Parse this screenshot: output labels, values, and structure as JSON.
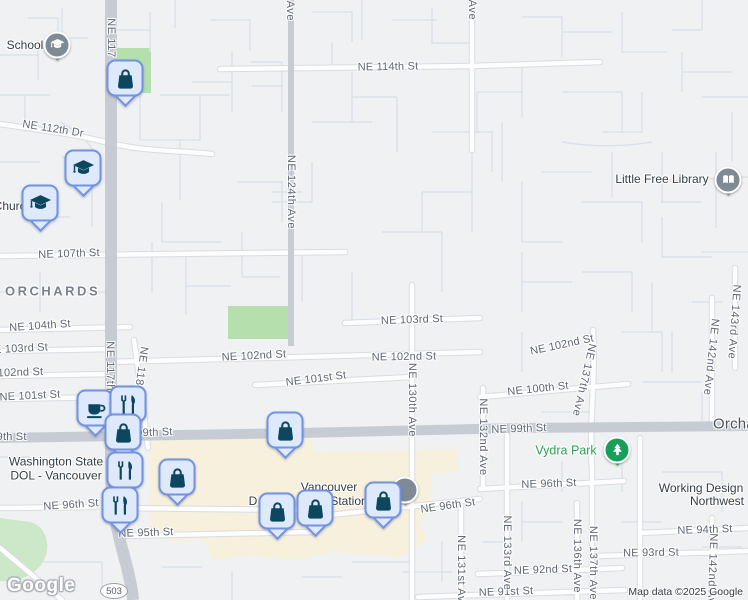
{
  "map": {
    "attribution": "Map data ©2025 Google",
    "watermark": "Google",
    "route_badge": "503"
  },
  "colors": {
    "land": "#f0f1f3",
    "commercial_area": "#f6f0dd",
    "park_green": "#b5e0ae",
    "marker_fill": "#dfe9fc",
    "marker_border": "#7292e2",
    "marker_glyph": "#0d475f",
    "poi_pin_gray": "#7e8b94",
    "park_pin_green": "#18a05b",
    "park_label_green": "#2f9e51"
  },
  "street_labels": [
    {
      "t": "NE 114th St",
      "x": 388,
      "y": 67,
      "r": -1
    },
    {
      "t": "NE 112th Dr",
      "x": 53,
      "y": 129,
      "r": 9
    },
    {
      "t": "NE 107th St",
      "x": 69,
      "y": 254,
      "r": -2
    },
    {
      "t": "NE 104th St",
      "x": 40,
      "y": 326,
      "r": -4
    },
    {
      "t": "NE 103rd St",
      "x": 17,
      "y": 349,
      "r": -3
    },
    {
      "t": "NE 102nd St",
      "x": 11,
      "y": 373,
      "r": -2
    },
    {
      "t": "NE 101st St",
      "x": 30,
      "y": 396,
      "r": -3
    },
    {
      "t": "NE 102nd St",
      "x": 254,
      "y": 356,
      "r": -3
    },
    {
      "t": "NE 102nd St",
      "x": 404,
      "y": 357,
      "r": -1
    },
    {
      "t": "NE 103rd St",
      "x": 412,
      "y": 320,
      "r": -2
    },
    {
      "t": "NE 101st St",
      "x": 316,
      "y": 379,
      "r": -7
    },
    {
      "t": "NE 102nd St",
      "x": 562,
      "y": 345,
      "r": -12
    },
    {
      "t": "NE 100th St",
      "x": 538,
      "y": 389,
      "r": -6
    },
    {
      "t": "NE 99th St",
      "x": -1,
      "y": 437,
      "r": 0
    },
    {
      "t": "NE 99th St",
      "x": 145,
      "y": 433,
      "r": -2
    },
    {
      "t": "NE 99th St",
      "x": 519,
      "y": 429,
      "r": -2
    },
    {
      "t": "NE 96th St",
      "x": 71,
      "y": 505,
      "r": -4
    },
    {
      "t": "NE 96th St",
      "x": 448,
      "y": 506,
      "r": -8
    },
    {
      "t": "NE 96th St",
      "x": 549,
      "y": 484,
      "r": -2
    },
    {
      "t": "NE 95th St",
      "x": 146,
      "y": 533,
      "r": -2
    },
    {
      "t": "NE 94th St",
      "x": 705,
      "y": 530,
      "r": -2
    },
    {
      "t": "NE 93rd St",
      "x": 651,
      "y": 553,
      "r": -1
    },
    {
      "t": "NE 92nd St",
      "x": 543,
      "y": 570,
      "r": -2
    },
    {
      "t": "NE 91st St",
      "x": 506,
      "y": 592,
      "r": -2
    }
  ],
  "avenue_labels": [
    {
      "t": "NE 117",
      "x": 111,
      "y": 38,
      "r": 0
    },
    {
      "t": "NE 117th Ave",
      "x": 110,
      "y": 378,
      "r": 0
    },
    {
      "t": "NE 118th Ave",
      "x": 139,
      "y": 383,
      "r": 8
    },
    {
      "t": "NE 124th Ave",
      "x": 290,
      "y": -16,
      "r": 0
    },
    {
      "t": "NE 124th Ave",
      "x": 291,
      "y": 192,
      "r": 0
    },
    {
      "t": "d Ave",
      "x": 472,
      "y": 5,
      "r": 0
    },
    {
      "t": "NE 130th Ave",
      "x": 412,
      "y": 400,
      "r": 0
    },
    {
      "t": "NE 132nd Ave",
      "x": 483,
      "y": 437,
      "r": 0
    },
    {
      "t": "NE 131st Ave",
      "x": 461,
      "y": 572,
      "r": 0
    },
    {
      "t": "NE 133rd Ave",
      "x": 507,
      "y": 553,
      "r": 0
    },
    {
      "t": "NE 136th Ave",
      "x": 577,
      "y": 556,
      "r": 0
    },
    {
      "t": "NE 137th Ave",
      "x": 593,
      "y": 563,
      "r": 0
    },
    {
      "t": "NE 137th Ave",
      "x": 584,
      "y": 380,
      "r": 13
    },
    {
      "t": "NE 142nd Ave",
      "x": 711,
      "y": 357,
      "r": 6
    },
    {
      "t": "NE 143rd Ave",
      "x": 734,
      "y": 322,
      "r": 4
    },
    {
      "t": "NE 142nd Ave",
      "x": 712,
      "y": 572,
      "r": 2
    }
  ],
  "poi_labels": [
    {
      "id": "school-label",
      "lines": [
        "School"
      ],
      "x": 25,
      "y": 45,
      "kind": "poi"
    },
    {
      "id": "church-label",
      "lines": [
        "Church"
      ],
      "x": 13,
      "y": 206,
      "kind": "poi"
    },
    {
      "id": "little-free-library-label",
      "lines": [
        "Little Free Library"
      ],
      "x": 662,
      "y": 179,
      "kind": "poi"
    },
    {
      "id": "wa-dol-label",
      "lines": [
        "Washington State",
        "DOL - Vancouver"
      ],
      "x": 56,
      "y": 469,
      "kind": "poi"
    },
    {
      "id": "vancouver-station-label",
      "lines": [
        "Vancouver"
      ],
      "x": 329,
      "y": 487,
      "kind": "poi"
    },
    {
      "id": "vancouver-station-label-d",
      "lines": [
        "D"
      ],
      "x": 253,
      "y": 501,
      "kind": "poi"
    },
    {
      "id": "vancouver-station-label-station",
      "lines": [
        "Station"
      ],
      "x": 349,
      "y": 501,
      "kind": "poi"
    },
    {
      "id": "vydra-park-label",
      "lines": [
        "Vydra Park"
      ],
      "x": 566,
      "y": 451,
      "kind": "park"
    },
    {
      "id": "working-design-label",
      "lines": [
        "Working Design"
      ],
      "x": 701,
      "y": 488,
      "kind": "poi"
    },
    {
      "id": "working-design-label-2",
      "lines": [
        "Northwest"
      ],
      "x": 717,
      "y": 501,
      "kind": "poi"
    }
  ],
  "area_labels": [
    {
      "t": "ORCHARDS",
      "x": 5,
      "y": 291,
      "kind": "district"
    },
    {
      "t": "Orchards",
      "x": 713,
      "y": 424,
      "kind": "locality"
    }
  ],
  "pins": [
    {
      "name": "school-pin",
      "icon": "graduation-cap",
      "x": 57,
      "y": 45,
      "color": "gray"
    },
    {
      "name": "library-pin",
      "icon": "book",
      "x": 728,
      "y": 180,
      "color": "gray"
    },
    {
      "name": "station-pin",
      "icon": "none",
      "x": 405,
      "y": 490,
      "color": "gray"
    },
    {
      "name": "vydra-park-pin",
      "icon": "tree",
      "x": 617,
      "y": 450,
      "color": "green"
    }
  ],
  "markers": [
    {
      "icon": "shopping-bag",
      "x": 125,
      "y": 78
    },
    {
      "icon": "graduation-cap",
      "x": 83,
      "y": 168
    },
    {
      "icon": "graduation-cap",
      "x": 40,
      "y": 203
    },
    {
      "icon": "coffee",
      "x": 95,
      "y": 408
    },
    {
      "icon": "restaurant",
      "x": 128,
      "y": 404
    },
    {
      "icon": "shopping-bag",
      "x": 123,
      "y": 432
    },
    {
      "icon": "shopping-bag",
      "x": 285,
      "y": 430
    },
    {
      "icon": "restaurant",
      "x": 125,
      "y": 470
    },
    {
      "icon": "shopping-bag",
      "x": 177,
      "y": 477
    },
    {
      "icon": "restaurant",
      "x": 120,
      "y": 505
    },
    {
      "icon": "shopping-bag",
      "x": 277,
      "y": 511
    },
    {
      "icon": "shopping-bag",
      "x": 315,
      "y": 508
    },
    {
      "icon": "shopping-bag",
      "x": 383,
      "y": 500
    }
  ]
}
